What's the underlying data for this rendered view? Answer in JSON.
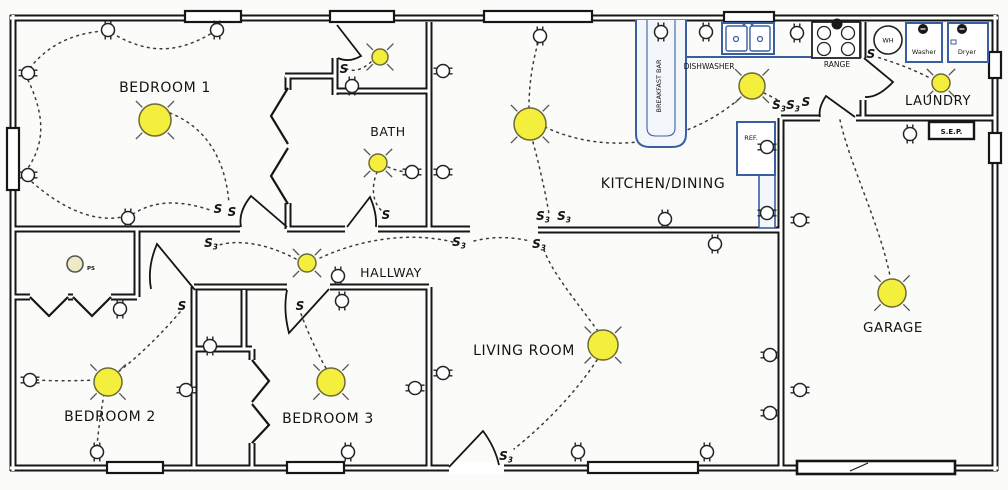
{
  "style": {
    "bg": "#fbfbf9",
    "wall": "#161616",
    "wire": "#3b3b3b",
    "light_fill": "#f4ee3c",
    "light_stroke": "#6e6a35",
    "ray": "#555555",
    "appliance": "#3a5fa0",
    "appliance_fill": "#f3f7fc",
    "text": "#141414"
  },
  "rooms": {
    "bedroom1": {
      "label": "BEDROOM 1",
      "x": 165,
      "y": 92,
      "fs": 14
    },
    "bath": {
      "label": "BATH",
      "x": 388,
      "y": 136,
      "fs": 12.5
    },
    "hallway": {
      "label": "HALLWAY",
      "x": 391,
      "y": 277,
      "fs": 12.5
    },
    "kitchen": {
      "label": "KITCHEN/DINING",
      "x": 663,
      "y": 188,
      "fs": 14
    },
    "living": {
      "label": "LIVING ROOM",
      "x": 524,
      "y": 355,
      "fs": 14
    },
    "bedroom2": {
      "label": "BEDROOM 2",
      "x": 110,
      "y": 421,
      "fs": 14
    },
    "bedroom3": {
      "label": "BEDROOM 3",
      "x": 328,
      "y": 423,
      "fs": 14
    },
    "laundry": {
      "label": "LAUNDRY",
      "x": 938,
      "y": 105,
      "fs": 13
    },
    "garage": {
      "label": "GARAGE",
      "x": 893,
      "y": 332,
      "fs": 13.5
    }
  },
  "appliances": {
    "breakfast_bar": {
      "label": "BREAKFAST BAR",
      "outer": "M636,20 V134 Q636,147 650,147 H672 Q686,147 686,134 V20",
      "inner": "M647,20 V128 Q647,136 656,136 H666 Q675,136 675,128 V20",
      "lx": 661,
      "ly": 86
    },
    "counter_edge": [
      686,
      57,
      812,
      57
    ],
    "counter2": {
      "x": 759,
      "y": 175,
      "w": 16,
      "h": 53
    },
    "dishwasher": {
      "label": "DISHWASHER",
      "lx": 709,
      "ly": 69
    },
    "sink": {
      "x": 722,
      "y": 23,
      "w": 52,
      "h": 31
    },
    "range": {
      "label": "RANGE",
      "x": 812,
      "y": 22,
      "w": 48,
      "h": 36,
      "lx": 837,
      "ly": 67,
      "outlet": [
        837,
        24
      ]
    },
    "ref": {
      "label": "REF.",
      "x": 737,
      "y": 122,
      "w": 38,
      "h": 53,
      "lx": 751,
      "ly": 140
    },
    "wh": {
      "label": "WH",
      "x": 888,
      "y": 40,
      "r": 14
    },
    "washer": {
      "label": "Washer",
      "x": 906,
      "y": 23,
      "w": 36,
      "h": 39,
      "lx": 924,
      "ly": 54,
      "outlet": [
        923,
        29
      ]
    },
    "dryer": {
      "label": "Dryer",
      "x": 948,
      "y": 23,
      "w": 40,
      "h": 39,
      "lx": 967,
      "ly": 54,
      "outlet": [
        962,
        29
      ],
      "vent": [
        951,
        40,
        5,
        4
      ]
    }
  },
  "sep": {
    "label": "S.E.P.",
    "x": 929,
    "y": 122,
    "w": 45,
    "h": 17
  },
  "ps_light": {
    "label": "PS",
    "x": 75,
    "y": 264,
    "r": 8,
    "lx": 87,
    "ly": 270
  },
  "garage_door": {
    "x": 797,
    "y": 461,
    "w": 158,
    "h": 13,
    "tick": [
      850,
      471,
      868,
      463
    ]
  },
  "walls": [
    [
      10,
      18,
      998,
      18
    ],
    [
      13,
      15,
      13,
      471
    ],
    [
      10,
      468,
      998,
      468
    ],
    [
      995,
      15,
      995,
      471
    ],
    [
      429,
      22,
      429,
      229
    ],
    [
      335,
      58,
      335,
      95
    ],
    [
      335,
      91,
      429,
      91
    ],
    [
      285,
      76,
      335,
      76
    ],
    [
      288,
      76,
      288,
      90
    ],
    [
      288,
      203,
      288,
      229
    ],
    [
      13,
      229,
      240,
      229
    ],
    [
      287,
      229,
      345,
      229
    ],
    [
      378,
      229,
      470,
      229
    ],
    [
      137,
      229,
      137,
      297
    ],
    [
      13,
      297,
      30,
      297
    ],
    [
      68,
      297,
      73,
      297
    ],
    [
      111,
      297,
      137,
      297
    ],
    [
      194,
      287,
      194,
      468
    ],
    [
      194,
      287,
      287,
      287
    ],
    [
      330,
      287,
      429,
      287
    ],
    [
      244,
      290,
      244,
      349
    ],
    [
      194,
      349,
      252,
      349
    ],
    [
      252,
      349,
      252,
      360
    ],
    [
      252,
      443,
      252,
      468
    ],
    [
      429,
      287,
      429,
      468
    ],
    [
      538,
      230,
      781,
      230
    ],
    [
      781,
      118,
      781,
      468
    ],
    [
      781,
      118,
      820,
      118
    ],
    [
      856,
      118,
      995,
      118
    ],
    [
      863,
      100,
      863,
      118
    ],
    [
      863,
      22,
      863,
      58
    ]
  ],
  "windows": [
    [
      185,
      11,
      56,
      11
    ],
    [
      330,
      11,
      64,
      11
    ],
    [
      484,
      11,
      108,
      11
    ],
    [
      724,
      12,
      50,
      10
    ],
    [
      7,
      128,
      12,
      62
    ],
    [
      107,
      462,
      56,
      11
    ],
    [
      287,
      462,
      57,
      11
    ],
    [
      588,
      462,
      110,
      11
    ],
    [
      989,
      52,
      12,
      26
    ],
    [
      989,
      133,
      12,
      30
    ]
  ],
  "door_gaps": [
    [
      449,
      462,
      55,
      12
    ]
  ],
  "doors": [
    "M287,227 L251,196 Q238,212 241,227",
    "M337,25 L361,56 Q349,63 338,58",
    "M347,227 L370,197 Q377,213 376,227",
    "M195,290 L157,244 Q147,267 151,289",
    "M329,289 L289,333 Q283,310 287,290",
    "M449,467 L483,431 Q495,447 499,465",
    "M864,58 L893,82 Q878,98 865,97",
    "M855,117 L826,96 Q818,108 820,117"
  ],
  "chevrons": [
    [
      [
        288,
        88
      ],
      [
        271,
        116
      ],
      [
        288,
        144
      ]
    ],
    [
      [
        288,
        148
      ],
      [
        271,
        176
      ],
      [
        288,
        204
      ]
    ],
    [
      [
        30,
        297
      ],
      [
        49,
        316
      ],
      [
        68,
        297
      ]
    ],
    [
      [
        73,
        297
      ],
      [
        92,
        316
      ],
      [
        111,
        297
      ]
    ],
    [
      [
        252,
        360
      ],
      [
        269,
        381
      ],
      [
        252,
        402
      ]
    ],
    [
      [
        252,
        404
      ],
      [
        269,
        425
      ],
      [
        252,
        443
      ]
    ]
  ],
  "wires": [
    "M30,68 C50,42 78,33 103,31",
    "M112,33 C150,56 180,52 212,33",
    "M28,80 C46,118 44,144 28,168",
    "M32,182 C66,212 98,222 122,217",
    "M133,214 C158,198 186,202 210,210",
    "M170,113 C208,128 226,162 229,204",
    "M371,62 C362,70 354,72 347,69",
    "M377,172 C370,190 374,204 382,211",
    "M388,167 C397,171 404,172 409,172",
    "M296,259 C264,242 236,240 219,245",
    "M320,258 C368,236 416,233 453,242",
    "M474,241 C494,236 512,237 530,241",
    "M180,312 C158,338 134,360 118,372",
    "M96,380 C72,381 52,381 36,380",
    "M104,394 C100,418 98,434 97,446",
    "M301,314 C310,338 320,358 327,370",
    "M598,331 C575,300 552,272 544,250",
    "M597,360 C572,398 538,430 514,449",
    "M533,142 C541,172 546,196 549,214",
    "M545,127 C610,158 690,142 740,98",
    "M538,43 C532,64 529,86 529,107",
    "M764,93 C772,97 777,99 780,102",
    "M928,77 C906,66 889,61 877,57",
    "M840,120 C850,165 880,225 890,276"
  ],
  "lights": [
    {
      "x": 155,
      "y": 120,
      "r": 16
    },
    {
      "x": 530,
      "y": 124,
      "r": 16
    },
    {
      "x": 752,
      "y": 86,
      "r": 13
    },
    {
      "x": 941,
      "y": 83,
      "r": 9
    },
    {
      "x": 380,
      "y": 57,
      "r": 8
    },
    {
      "x": 378,
      "y": 163,
      "r": 9
    },
    {
      "x": 307,
      "y": 263,
      "r": 9
    },
    {
      "x": 108,
      "y": 382,
      "r": 14
    },
    {
      "x": 331,
      "y": 382,
      "r": 14
    },
    {
      "x": 603,
      "y": 345,
      "r": 15
    },
    {
      "x": 892,
      "y": 293,
      "r": 14
    }
  ],
  "outlets": [
    {
      "x": 108,
      "y": 30,
      "o": "v"
    },
    {
      "x": 217,
      "y": 30,
      "o": "v"
    },
    {
      "x": 128,
      "y": 218,
      "o": "v"
    },
    {
      "x": 352,
      "y": 86,
      "o": "v"
    },
    {
      "x": 540,
      "y": 36,
      "o": "v"
    },
    {
      "x": 661,
      "y": 32,
      "o": "v"
    },
    {
      "x": 706,
      "y": 32,
      "o": "v"
    },
    {
      "x": 797,
      "y": 33,
      "o": "v"
    },
    {
      "x": 665,
      "y": 219,
      "o": "v"
    },
    {
      "x": 715,
      "y": 244,
      "o": "v"
    },
    {
      "x": 910,
      "y": 134,
      "o": "v"
    },
    {
      "x": 578,
      "y": 452,
      "o": "v"
    },
    {
      "x": 707,
      "y": 452,
      "o": "v"
    },
    {
      "x": 97,
      "y": 452,
      "o": "v"
    },
    {
      "x": 348,
      "y": 452,
      "o": "v"
    },
    {
      "x": 338,
      "y": 276,
      "o": "v"
    },
    {
      "x": 342,
      "y": 301,
      "o": "v"
    },
    {
      "x": 210,
      "y": 346,
      "o": "v"
    },
    {
      "x": 120,
      "y": 309,
      "o": "v"
    },
    {
      "x": 28,
      "y": 73,
      "o": "h"
    },
    {
      "x": 28,
      "y": 175,
      "o": "h"
    },
    {
      "x": 30,
      "y": 380,
      "o": "h"
    },
    {
      "x": 186,
      "y": 390,
      "o": "h"
    },
    {
      "x": 415,
      "y": 388,
      "o": "h"
    },
    {
      "x": 412,
      "y": 172,
      "o": "h"
    },
    {
      "x": 443,
      "y": 71,
      "o": "h"
    },
    {
      "x": 443,
      "y": 172,
      "o": "h"
    },
    {
      "x": 443,
      "y": 373,
      "o": "h"
    },
    {
      "x": 767,
      "y": 147,
      "o": "h"
    },
    {
      "x": 767,
      "y": 213,
      "o": "h"
    },
    {
      "x": 800,
      "y": 220,
      "o": "h"
    },
    {
      "x": 800,
      "y": 390,
      "o": "h"
    },
    {
      "x": 770,
      "y": 355,
      "o": "h"
    },
    {
      "x": 770,
      "y": 413,
      "o": "h"
    }
  ],
  "switches": [
    {
      "x": 218,
      "y": 213,
      "l": "S",
      "sub": ""
    },
    {
      "x": 232,
      "y": 216,
      "l": "S",
      "sub": ""
    },
    {
      "x": 211,
      "y": 247,
      "l": "S",
      "sub": "3"
    },
    {
      "x": 344,
      "y": 73,
      "l": "S",
      "sub": ""
    },
    {
      "x": 386,
      "y": 219,
      "l": "S",
      "sub": ""
    },
    {
      "x": 459,
      "y": 246,
      "l": "S",
      "sub": "3"
    },
    {
      "x": 182,
      "y": 310,
      "l": "S",
      "sub": ""
    },
    {
      "x": 300,
      "y": 310,
      "l": "S",
      "sub": ""
    },
    {
      "x": 543,
      "y": 220,
      "l": "S",
      "sub": "3"
    },
    {
      "x": 564,
      "y": 220,
      "l": "S",
      "sub": "3"
    },
    {
      "x": 539,
      "y": 248,
      "l": "S",
      "sub": "3"
    },
    {
      "x": 506,
      "y": 460,
      "l": "S",
      "sub": "3"
    },
    {
      "x": 779,
      "y": 109,
      "l": "S",
      "sub": "3"
    },
    {
      "x": 793,
      "y": 109,
      "l": "S",
      "sub": "3"
    },
    {
      "x": 806,
      "y": 106,
      "l": "S",
      "sub": ""
    },
    {
      "x": 871,
      "y": 58,
      "l": "S",
      "sub": ""
    }
  ]
}
